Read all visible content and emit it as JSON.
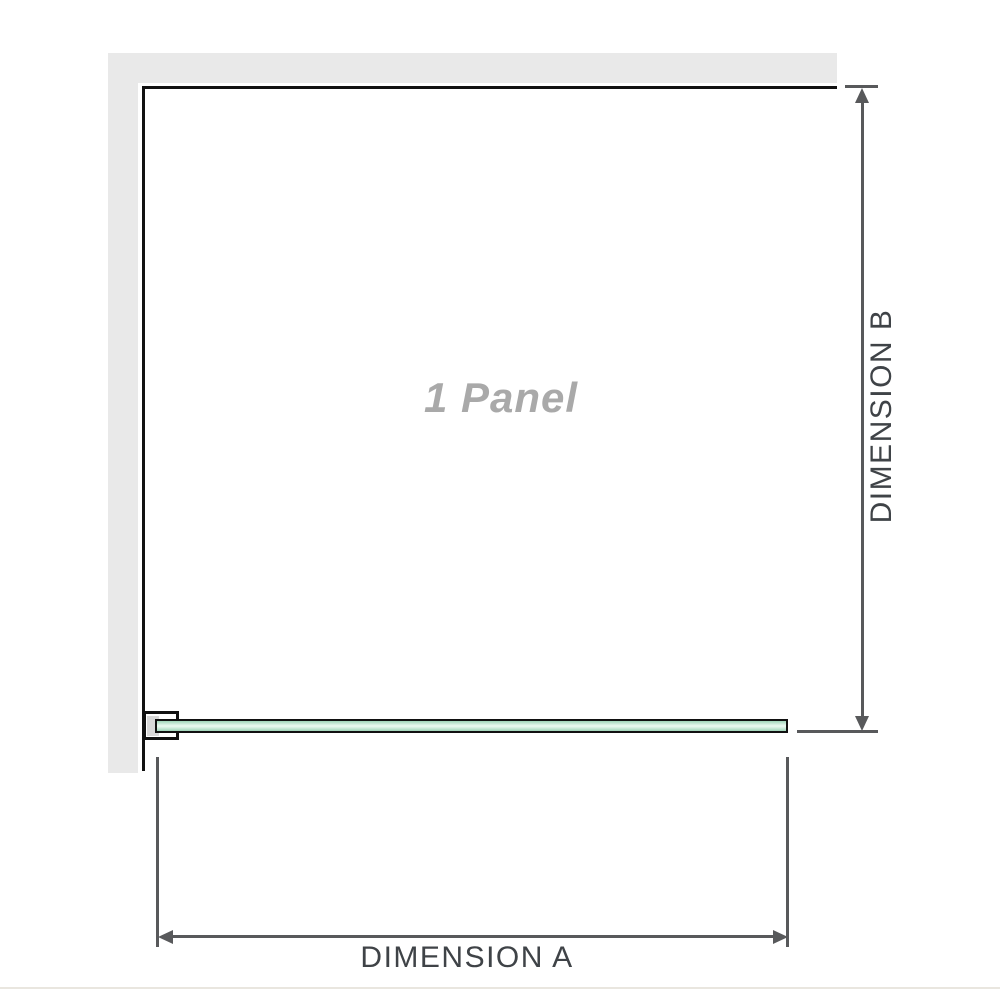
{
  "diagram": {
    "panel_label": "1 Panel",
    "dimension_a_label": "DIMENSION A",
    "dimension_b_label": "DIMENSION B"
  },
  "colors": {
    "wall": "#e9e9e9",
    "panel_edge": "#111111",
    "glass_green_edge": "#9fd4b8",
    "glass_green_light": "#e7f7ee",
    "dimension_line": "#58595b",
    "dimension_text": "#3f4347",
    "panel_label_text": "#a9a9a9",
    "bottom_divider": "#e9e6df"
  }
}
